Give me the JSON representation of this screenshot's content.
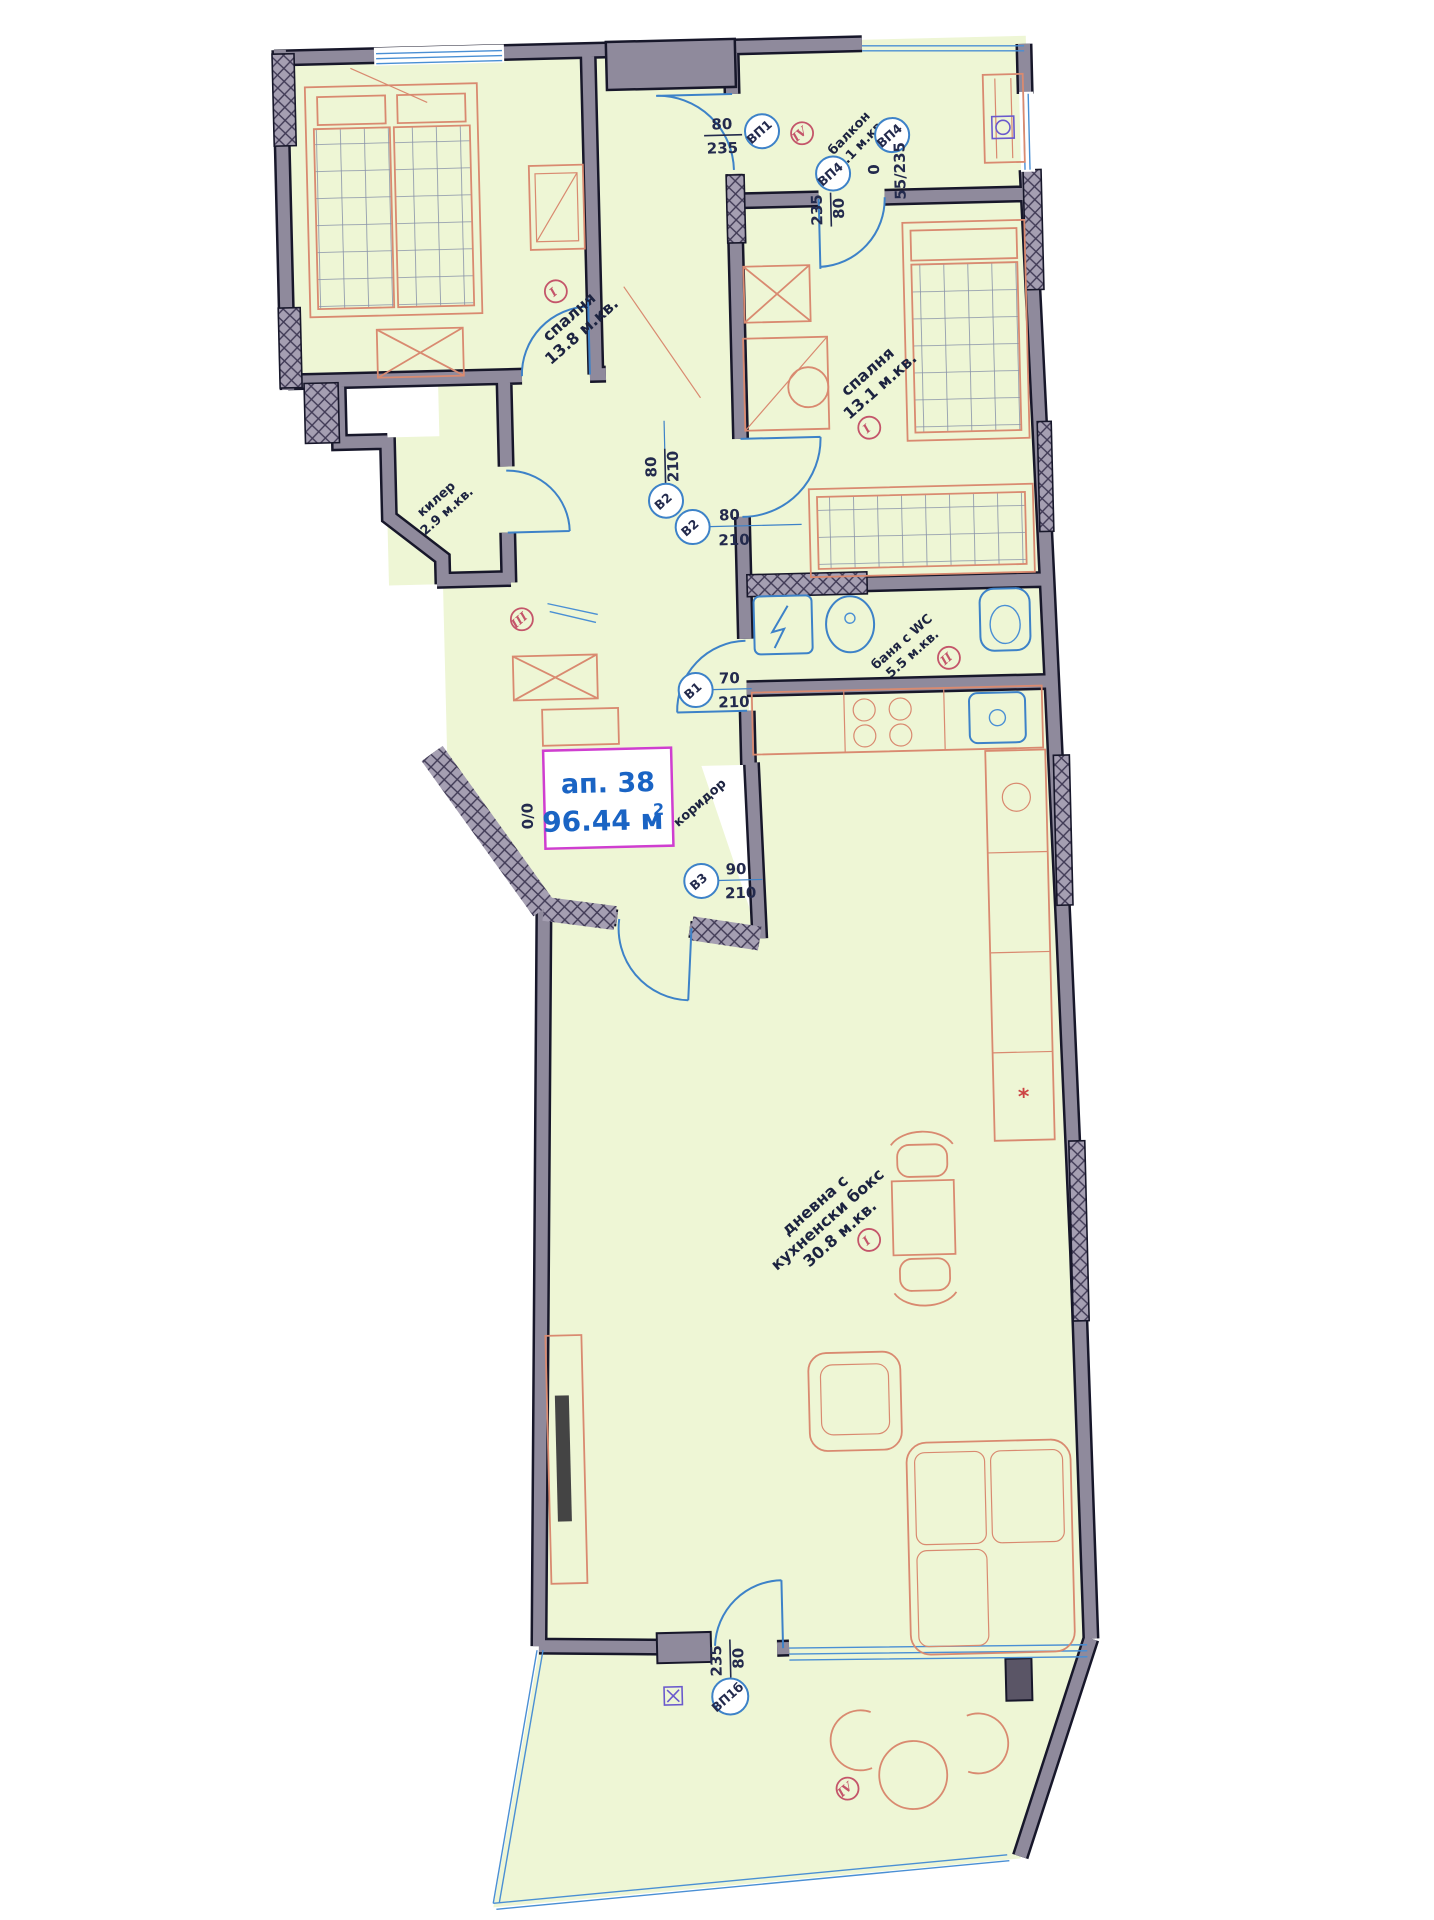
{
  "apartment": {
    "number": "ап. 38",
    "area_value": "96.44 м",
    "area_sup": "2",
    "zero_marker": "0/0"
  },
  "rooms": [
    {
      "name": "спалня",
      "area": "13.8 м.кв.",
      "finish": "I"
    },
    {
      "name": "спалня",
      "area": "13.1 м.кв.",
      "finish": "I"
    },
    {
      "name": "балкон",
      "area": "4.1 м.кв.",
      "finish": "IV"
    },
    {
      "name": "килер",
      "area": "2.9 м.кв.",
      "finish": "III"
    },
    {
      "name": "баня с WC",
      "area": "5.5 м.кв.",
      "finish": "II"
    },
    {
      "name": "дневна с",
      "name2": "кухненски бокс",
      "area": "30.8 м.кв.",
      "finish": "I"
    },
    {
      "name": "коридор"
    },
    {
      "finish": "IV"
    }
  ],
  "doors": [
    {
      "code": "ВП1",
      "dim_top": "80",
      "dim_bottom": "235"
    },
    {
      "code": "ВП4",
      "dim": "55/235",
      "sill": "0"
    },
    {
      "code": "ВП4",
      "dim_top": "235",
      "dim_bottom": "80"
    },
    {
      "code": "В2",
      "dim_top": "80",
      "dim_bottom": "210"
    },
    {
      "code": "В2",
      "dim_top": "80",
      "dim_bottom": "210"
    },
    {
      "code": "В1",
      "dim_top": "70",
      "dim_bottom": "210"
    },
    {
      "code": "В3",
      "dim_top": "90",
      "dim_bottom": "210"
    },
    {
      "code": "ВП1б",
      "dim_top": "235",
      "dim_bottom": "80"
    }
  ],
  "misc": {
    "kitchen_star": "*"
  },
  "colors": {
    "room_fill": "#eef6d5",
    "wall_fill": "#8f8a9c",
    "wall_edge": "#17172a",
    "furniture": "#d98a70",
    "fixtures_blue": "#3d82c8",
    "label_navy": "#232a4d",
    "apartment_blue": "#1a64c4",
    "box_border": "#cf3ed0",
    "finish_red": "#c4556a"
  }
}
